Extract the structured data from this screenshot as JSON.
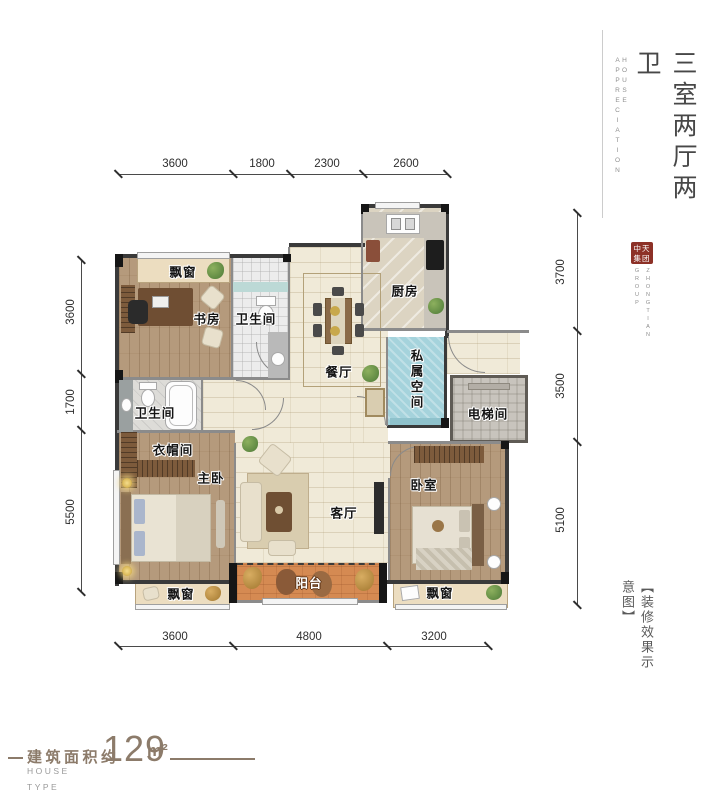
{
  "header": {
    "title_vertical": "三室两厅两卫",
    "subtitle_vertical": "HOUSE APPRECIATION"
  },
  "logo": {
    "seal_line1": "中天",
    "seal_line2": "集团",
    "name_col_right": "ZHONGTIAN",
    "name_col_left": "GROUP"
  },
  "caption": {
    "text": "【装修效果示意图】"
  },
  "footer": {
    "area_label": "建筑面积约",
    "area_value": "129",
    "area_unit": "m²",
    "line1": "HOUSE",
    "line2": "TYPE"
  },
  "plan": {
    "rooms": {
      "study": "书房",
      "bath_top": "卫生间",
      "kitchen": "厨房",
      "dining": "餐厅",
      "private_space": "私属空间",
      "elevator": "电梯间",
      "bath_mid": "卫生间",
      "cloakroom": "衣帽间",
      "master": "主卧",
      "living": "客厅",
      "bedroom": "卧室",
      "balcony": "阳台",
      "bay_window_top": "飘窗",
      "bay_window_left": "飘窗",
      "bay_window_right": "飘窗"
    },
    "dimensions": {
      "top": [
        "3600",
        "1800",
        "2300",
        "2600"
      ],
      "bottom": [
        "3600",
        "4800",
        "3200"
      ],
      "left": [
        "3600",
        "1700",
        "5500"
      ],
      "right": [
        "3700",
        "3500",
        "5100"
      ]
    }
  },
  "colors": {
    "seal_red": "#8d3127",
    "private_space_teal": "#a5d3dc",
    "balcony_orange": "#d58a52",
    "wood_floor": "#b59a7c",
    "tile_cream": "#f0ead8",
    "footer_brown": "#8c7b6a"
  }
}
